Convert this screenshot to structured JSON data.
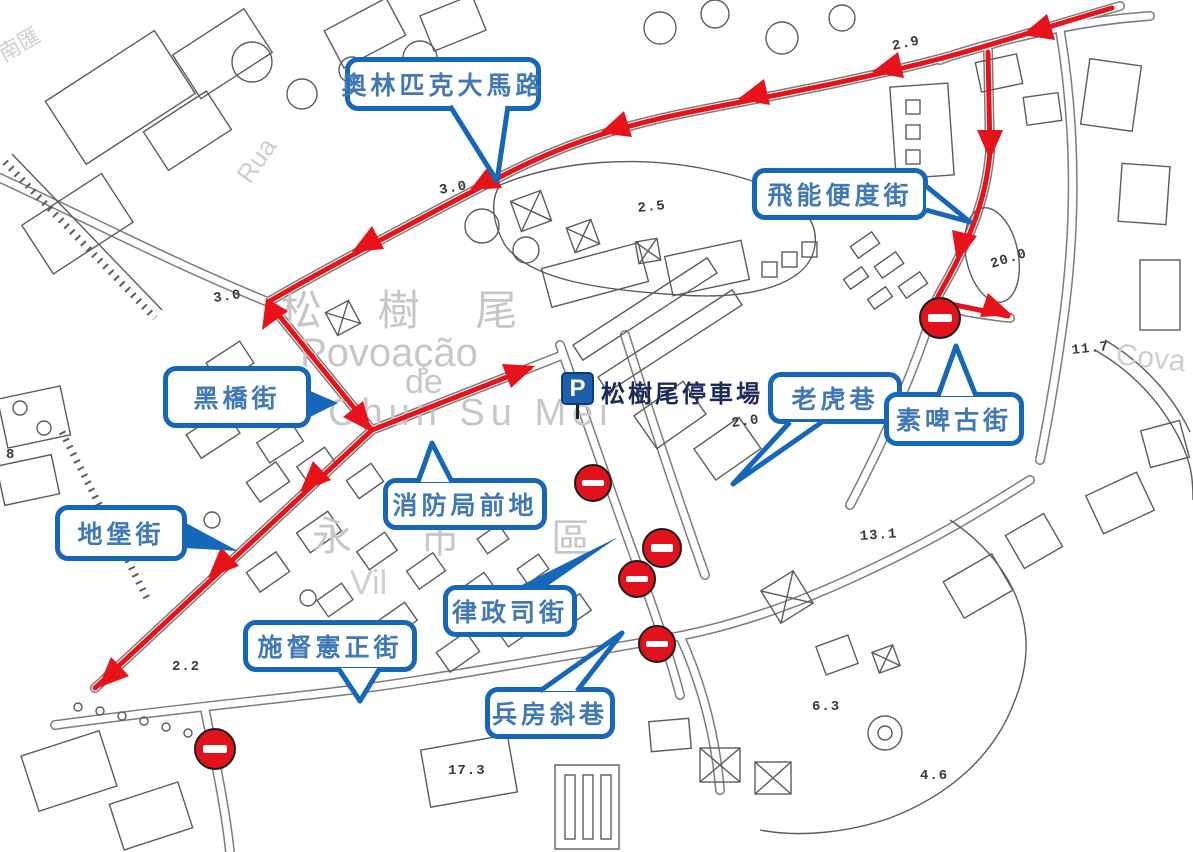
{
  "colors": {
    "route_red": "#e8131a",
    "no_entry_red": "#e3111c",
    "callout_border_blue": "#1767b8",
    "callout_text_blue": "#4079b5",
    "parking_blue": "#1d5fae",
    "base_map_gray": "#5c5c5c",
    "faint_text_gray": "#c7c7c7"
  },
  "callouts": [
    {
      "label": "奧林匹克大馬路"
    },
    {
      "label": "飛能便度街"
    },
    {
      "label": "黑橋街"
    },
    {
      "label": "老虎巷"
    },
    {
      "label": "素啤古街"
    },
    {
      "label": "消防局前地"
    },
    {
      "label": "地堡街"
    },
    {
      "label": "律政司街"
    },
    {
      "label": "施督憲正街"
    },
    {
      "label": "兵房斜巷"
    }
  ],
  "parking": {
    "icon": "P",
    "label": "松樹尾停車場"
  },
  "elevations": [
    "2.9",
    "3.0",
    "2.5",
    "3.0",
    "20.0",
    "11.7",
    "2.0",
    "13.1",
    "2.2",
    "6.3",
    "17.3",
    "4.6",
    "8"
  ],
  "base_map_texts": {
    "district_cn": "松 樹 尾",
    "district_pt1": "Povoação",
    "district_pt2": "de",
    "district_pt3": "Chun  Su  Mei",
    "rua": "Rua",
    "cova": "Cova",
    "wing": "永",
    "district_cn2": "市 區",
    "vila": "Vil",
    "corner_cn": "南匯"
  }
}
